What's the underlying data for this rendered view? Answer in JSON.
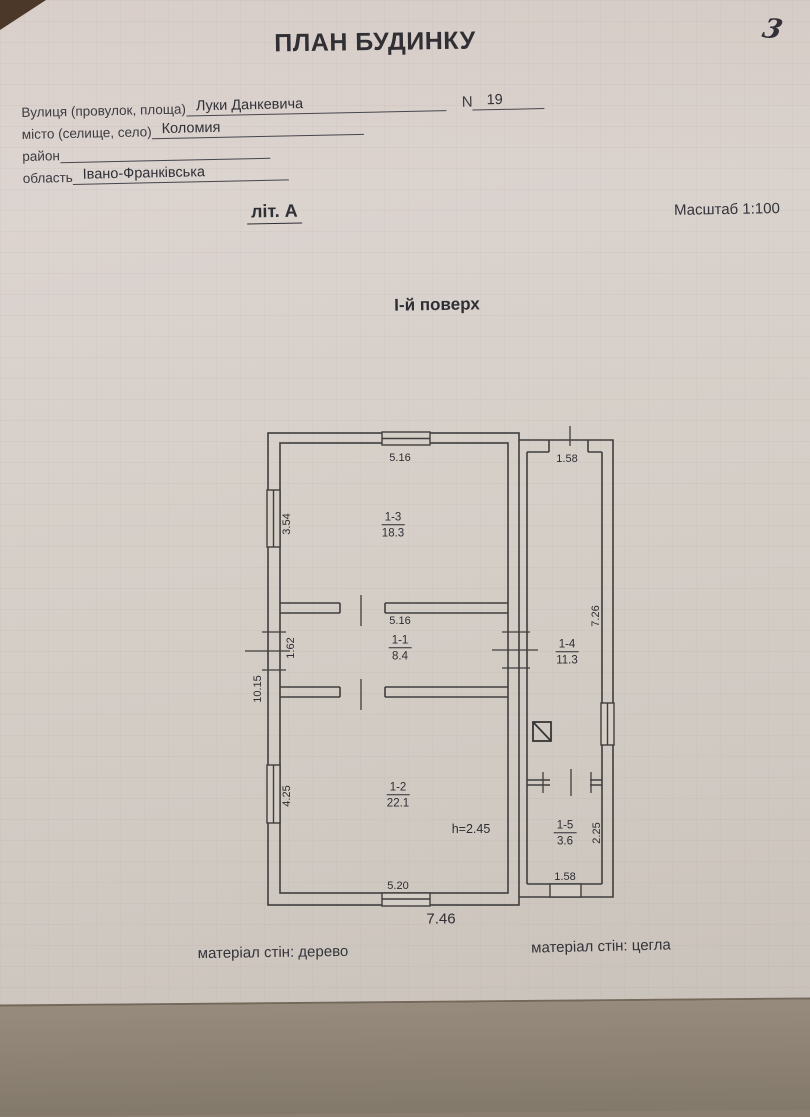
{
  "page": {
    "page_number": "3",
    "title": "ПЛАН БУДИНКУ",
    "form": {
      "street_label": "Вулиця (провулок, площа)",
      "street_value": "Луки Данкевича",
      "number_label": "N",
      "number_value": "19",
      "city_label": "місто (селище, село)",
      "city_value": "Коломия",
      "district_label": "район",
      "district_value": "",
      "region_label": "область",
      "region_value": "Івано-Франківська"
    },
    "letter_label": "літ. А",
    "scale_label": "Масштаб 1:100",
    "floor_label": "І-й поверх",
    "materials": {
      "left": "матеріал стін: дерево",
      "right": "матеріал стін: цегла"
    },
    "colors": {
      "ink": "#33333a",
      "paper": "#d5cec7",
      "table": "#83796b"
    }
  },
  "plan": {
    "rooms": [
      {
        "id": "1-3",
        "area": "18.3"
      },
      {
        "id": "1-1",
        "area": "8.4"
      },
      {
        "id": "1-2",
        "area": "22.1"
      },
      {
        "id": "1-4",
        "area": "11.3"
      },
      {
        "id": "1-5",
        "area": "3.6"
      }
    ],
    "height_note": "h=2.45",
    "dims": {
      "d_516_top": "5.16",
      "d_158_top": "1.58",
      "d_354": "3.54",
      "d_516_mid": "5.16",
      "d_162": "1.62",
      "d_1015": "10.15",
      "d_726": "7.26",
      "d_425": "4.25",
      "d_225": "2.25",
      "d_520": "5.20",
      "d_158_bottom": "1.58",
      "d_746": "7.46"
    }
  }
}
